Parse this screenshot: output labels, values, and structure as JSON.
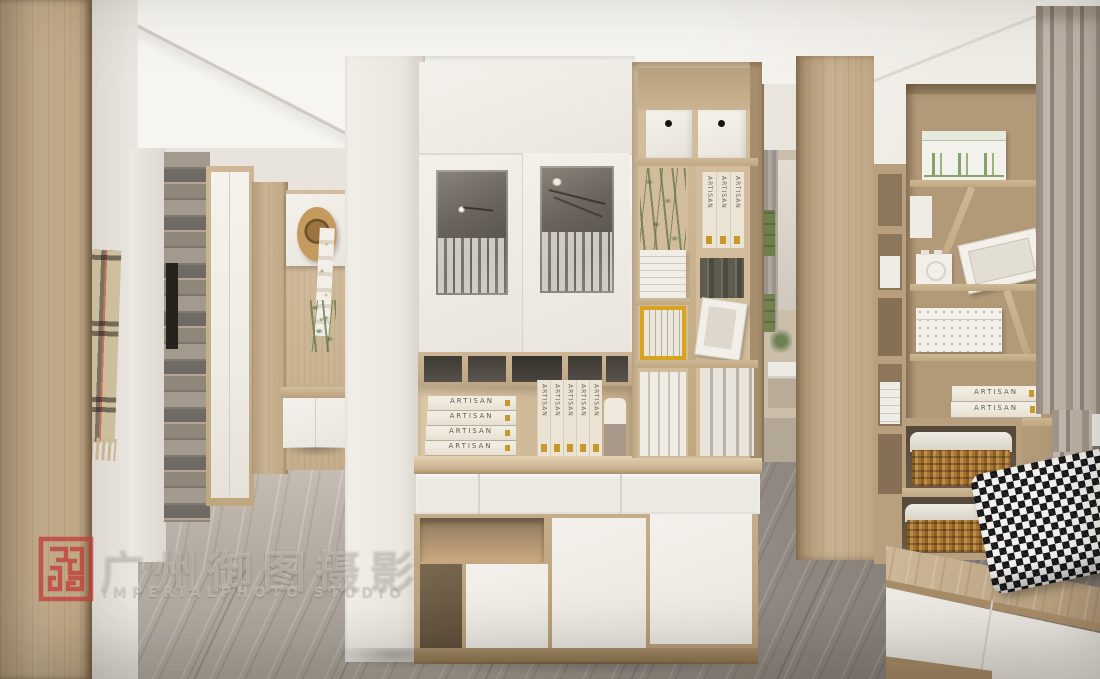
{
  "watermark": {
    "cn": "广州御图摄影",
    "en": "IMPERIALPHOTO STUDIO"
  },
  "books": {
    "artisan": "ARTISAN"
  },
  "colors": {
    "wood": "#c6b090",
    "wood_dark": "#a78c68",
    "panel_white": "#f0ede7",
    "floor_gray": "#a8a096",
    "seal_red": "#c04038",
    "curtain": "#b7ab9d",
    "basket_wicker": "#c08d45",
    "plant_green": "#6d7f55",
    "accent_yellow": "#d8a31e",
    "houndstooth_black": "#17171a"
  }
}
